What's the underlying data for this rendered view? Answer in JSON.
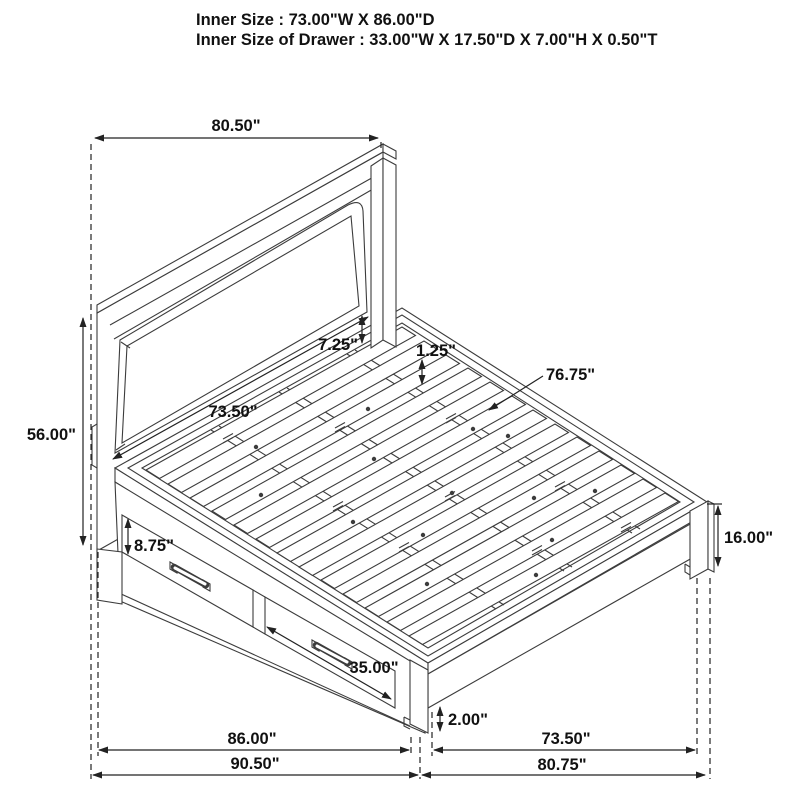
{
  "header": {
    "line1": "Inner Size : 73.00\"W X 86.00\"D",
    "line2": "Inner Size of Drawer : 33.00\"W X 17.50\"D X 7.00\"H X 0.50\"T"
  },
  "dims": {
    "headboard_width": "80.50\"",
    "headboard_height": "56.00\"",
    "headboard_panel_width": "73.50\"",
    "panel_gap": "7.25\"",
    "slat_recess": "1.25\"",
    "deck_length": "76.75\"",
    "drawer_height": "8.75\"",
    "drawer_width": "35.00\"",
    "rail_height": "16.00\"",
    "clearance": "2.00\"",
    "inner_length": "86.00\"",
    "overall_length": "90.50\"",
    "inner_width": "73.50\"",
    "overall_width": "80.75\""
  },
  "colors": {
    "line": "#3c3c3c",
    "dimension": "#222222",
    "text": "#111111",
    "background": "#ffffff"
  }
}
